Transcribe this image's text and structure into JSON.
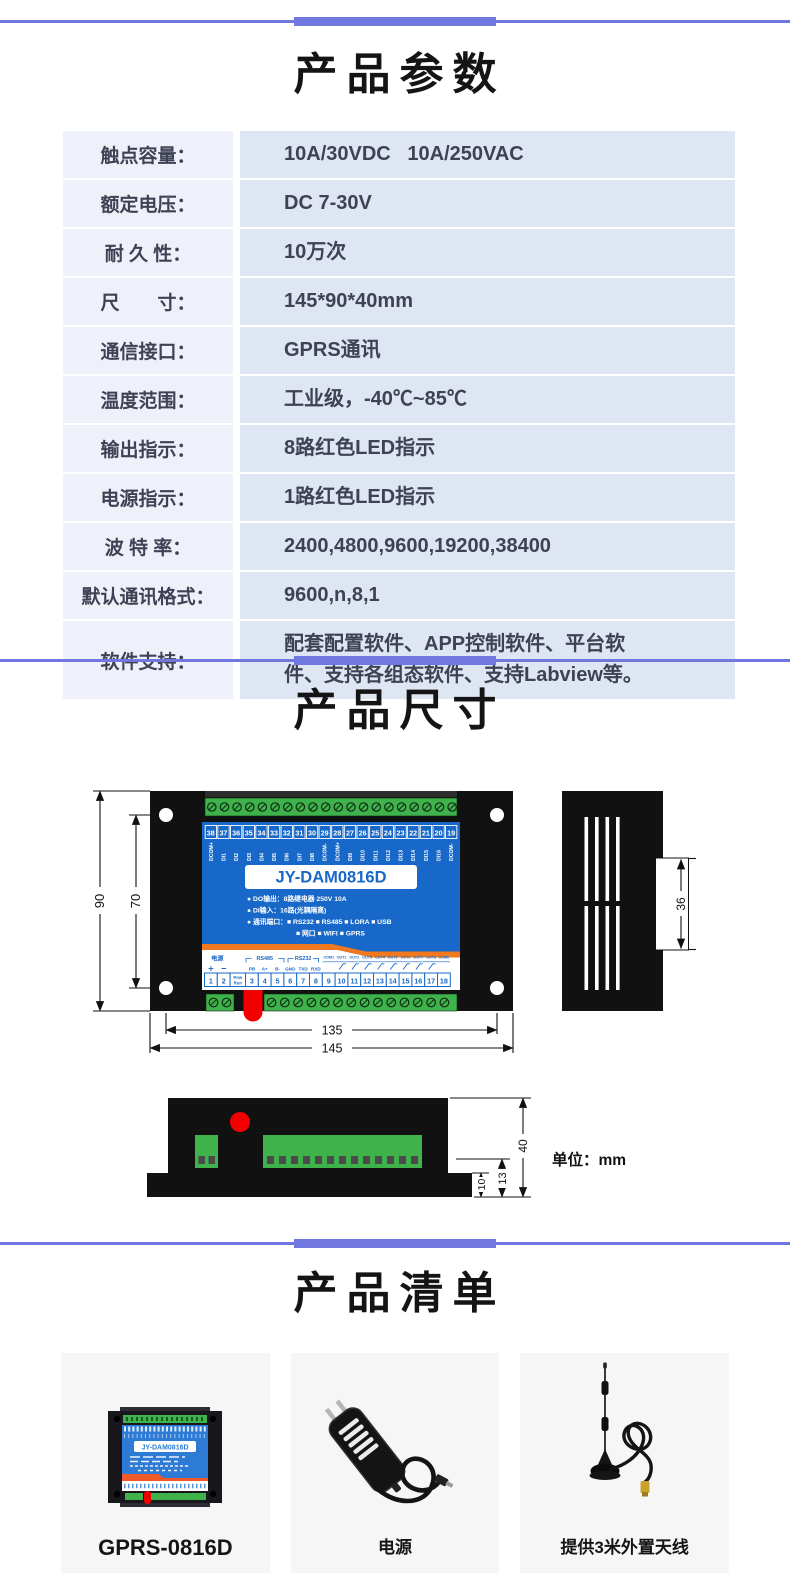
{
  "colors": {
    "accent": "#7077df",
    "panel_blue": "#1768c8",
    "stripe_orange": "#f0781e",
    "terminal_green": "#3fb24b",
    "connector_red": "#f20000",
    "drawing_black": "#111111",
    "table_label_bg": "#eef1f9",
    "table_value_bg": "#dee5f3",
    "text_dark": "#3f4254",
    "card_bg": "#f6f6f7"
  },
  "sections": {
    "parameters": {
      "title": "产品参数",
      "rows": [
        {
          "label": "触点容量：",
          "value": "10A/30VDC   10A/250VAC"
        },
        {
          "label": "额定电压：",
          "value": "DC 7-30V"
        },
        {
          "label": "耐 久 性：",
          "value": "10万次"
        },
        {
          "label": "尺　　寸：",
          "value": "145*90*40mm"
        },
        {
          "label": "通信接口：",
          "value": "GPRS通讯"
        },
        {
          "label": "温度范围：",
          "value": "工业级，-40℃~85℃"
        },
        {
          "label": "输出指示：",
          "value": "8路红色LED指示"
        },
        {
          "label": "电源指示：",
          "value": "1路红色LED指示"
        },
        {
          "label": "波 特 率：",
          "value": "2400,4800,9600,19200,38400"
        },
        {
          "label": "默认通讯格式：",
          "value": "9600,n,8,1"
        },
        {
          "label": "软件支持：",
          "value": "配套配置软件、APP控制软件、平台软件、支持各组态软件、支持Labview等。"
        }
      ]
    },
    "dimensions": {
      "title": "产品尺寸",
      "unit_note": "单位：mm",
      "front_view": {
        "model": "JY-DAM0816D",
        "top_terminal_numbers": [
          "38",
          "37",
          "36",
          "35",
          "34",
          "33",
          "32",
          "31",
          "30",
          "29",
          "28",
          "27",
          "26",
          "25",
          "24",
          "23",
          "22",
          "21",
          "20",
          "19"
        ],
        "top_terminal_labels": [
          "DCOM+",
          "DI1",
          "DI2",
          "DI3",
          "DI4",
          "DI5",
          "DI6",
          "DI7",
          "DI8",
          "DCOM-",
          "DCOM+",
          "DI9",
          "DI10",
          "DI11",
          "DI12",
          "DI13",
          "DI14",
          "DI15",
          "DI16",
          "DCOM-"
        ],
        "spec_lines": [
          "● DO输出：8路继电器 250V 10A",
          "● DI输入：16路(光耦隔离)",
          "● 通讯端口：■ RS232  ■ RS485  ■ LORA  ■ USB",
          "■ 网口   ■ WIFI   ■ GPRS"
        ],
        "power_label": "电源",
        "power_pins": [
          "+",
          "−"
        ],
        "pow_run": "Pow Run",
        "rs485_label": "RS485",
        "rs485_pins": [
          "PB",
          "A+",
          "B-"
        ],
        "rs232_label": "RS232",
        "rs232_pins": [
          "GND",
          "TXD",
          "RXD"
        ],
        "out_labels": [
          "COM1",
          "OUT1",
          "OUT2",
          "OUT3",
          "OUT4",
          "OUT5",
          "OUT6",
          "OUT7",
          "OUT8",
          "COM2"
        ],
        "bottom_terminal_numbers": [
          "1",
          "2",
          "3",
          "4",
          "5",
          "6",
          "7",
          "8",
          "9",
          "10",
          "11",
          "12",
          "13",
          "14",
          "15",
          "16",
          "17",
          "18"
        ],
        "dim_height_outer": "90",
        "dim_height_inner": "70",
        "dim_width_inner": "135",
        "dim_width_outer": "145"
      },
      "side_view": {
        "dim_depth": "36"
      },
      "bottom_view": {
        "dim_total": "40",
        "dim_step": "13",
        "dim_flange": "10"
      }
    },
    "list": {
      "title": "产品清单",
      "items": [
        {
          "name": "GPRS-0816D",
          "label_on_device": "JY-DAM0816D"
        },
        {
          "name": "电源"
        },
        {
          "name": "提供3米外置天线"
        }
      ]
    }
  }
}
